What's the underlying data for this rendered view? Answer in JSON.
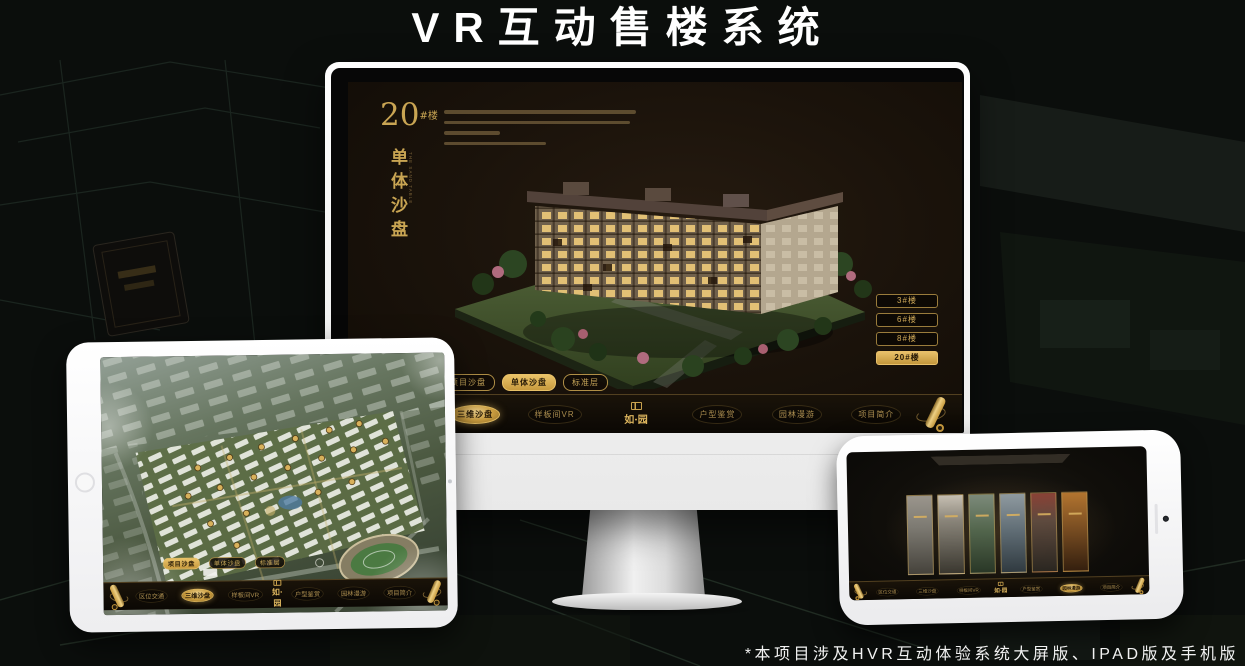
{
  "page": {
    "title": "VR互动售楼系统",
    "footnote": "*本项目涉及HVR互动体验系统大屏版、IPAD版及手机版"
  },
  "brand": {
    "accent_gold": "#c9a14e",
    "accent_gold_bright": "#e9c268",
    "screen_background": "#1b130b"
  },
  "desktop_screen": {
    "headline": {
      "number": "20",
      "unit": "#楼",
      "subtitle": "单体沙盘",
      "subtitle_en": "THE SAND TABLE"
    },
    "building_buttons": [
      {
        "label": "3#楼"
      },
      {
        "label": "6#楼"
      },
      {
        "label": "8#楼"
      },
      {
        "label": "20#楼"
      }
    ],
    "active_building": "20#楼",
    "view_tabs": [
      {
        "label": "项目沙盘"
      },
      {
        "label": "单体沙盘"
      },
      {
        "label": "标准层"
      }
    ],
    "active_tab": "单体沙盘",
    "nav": {
      "logo": "如·园",
      "active_item": "三维沙盘",
      "items": [
        {
          "label": "区位交通"
        },
        {
          "label": "三维沙盘"
        },
        {
          "label": "样板间VR"
        },
        {
          "label": "户型鉴赏"
        },
        {
          "label": "园林漫游"
        },
        {
          "label": "项目简介"
        }
      ]
    }
  },
  "ipad_screen": {
    "view_tabs": [
      {
        "label": "项目沙盘"
      },
      {
        "label": "单体沙盘"
      },
      {
        "label": "标准层"
      }
    ],
    "active_tab": "项目沙盘",
    "nav": {
      "logo": "如·园",
      "active_item": "三维沙盘",
      "items": [
        {
          "label": "区位交通"
        },
        {
          "label": "三维沙盘"
        },
        {
          "label": "样板间VR"
        },
        {
          "label": "户型鉴赏"
        },
        {
          "label": "园林漫游"
        },
        {
          "label": "项目简介"
        }
      ]
    }
  },
  "phone_screen": {
    "nav": {
      "logo": "如·园",
      "active_item": "园林漫游",
      "items": [
        {
          "label": "区位交通"
        },
        {
          "label": "三维沙盘"
        },
        {
          "label": "样板间VR"
        },
        {
          "label": "户型鉴赏"
        },
        {
          "label": "园林漫游"
        },
        {
          "label": "项目简介"
        }
      ]
    }
  }
}
